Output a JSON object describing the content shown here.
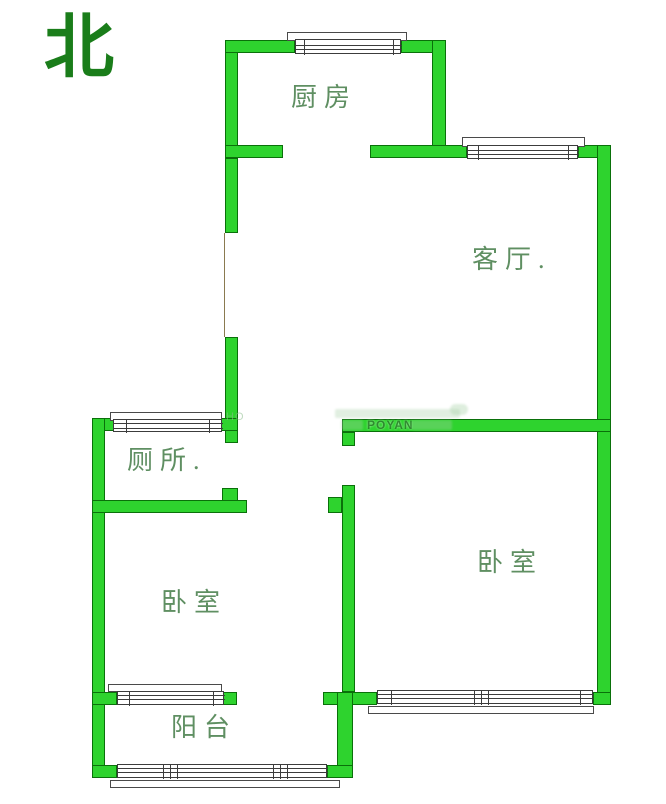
{
  "north_label": "北",
  "rooms": {
    "kitchen": {
      "label": "厨房"
    },
    "living_room": {
      "label": "客厅."
    },
    "toilet": {
      "label": "厕所."
    },
    "bedroom_right": {
      "label": "卧室"
    },
    "bedroom_left": {
      "label": "卧室"
    },
    "balcony": {
      "label": "阳台"
    }
  },
  "watermark": {
    "line1": "HO",
    "brand": "POYAN"
  },
  "colors": {
    "wall_fill": "#2ed32e",
    "wall_border": "#0a700a",
    "north_text": "#1a7d1a",
    "room_label": "#5f8f62",
    "window_line": "#3c3c3c",
    "background": "#ffffff"
  }
}
